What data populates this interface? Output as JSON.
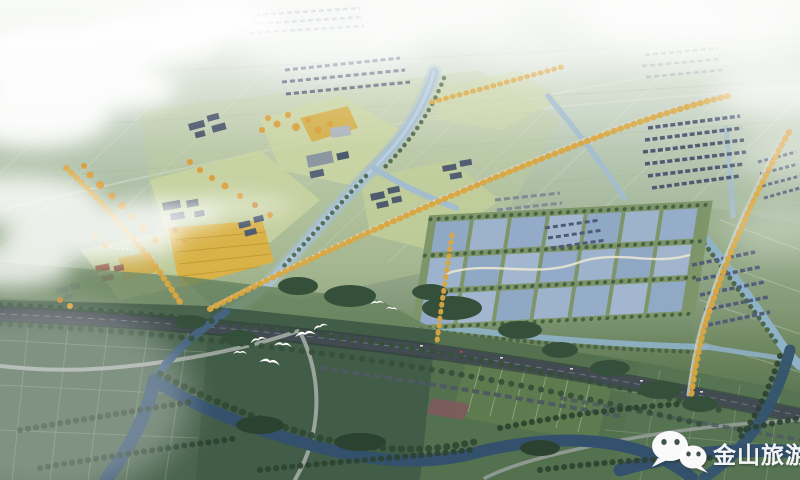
{
  "image": {
    "title": "Aerial bird's-eye rendering of a river-town masterplan",
    "description": "Hazy aerial view: town center with canals and golden tree-lined avenues, grid of aquaculture fish ponds, village housing rows, a tree-lined highway crossing the foreground farmland, white egrets in flight"
  },
  "watermark": {
    "brand": "金山旅游",
    "icon": "wechat-icon",
    "text_color": "#ffffff"
  },
  "features": {
    "sky": "hazy white clouds",
    "far_farmland": "pale field grid fading to horizon",
    "town_center": "riverside town with lawns and dark-roof buildings",
    "golden_avenues": "roads lined with golden autumn trees",
    "fish_ponds": "rectangular aquaculture pond grid",
    "village_rows": "rows of dark-roof village houses",
    "highway": "tree-lined dual highway",
    "canals": "winding blue canals and rivers",
    "foreground_fields": "dark green patchwork farmland",
    "birds": "white egrets flying"
  },
  "palette": {
    "haze": "#ecf1ea",
    "far_field": "#c2d1c0",
    "lawn": "#ccd6a0",
    "golden_field": "#d9b348",
    "autumn_tree": "#dba73f",
    "river_light": "#a5bfd0",
    "river_dark": "#33516c",
    "pond_blue": "#97aec9",
    "highway_gray": "#3c4449",
    "road_light": "#cfd6cc",
    "near_field": "#4e6750",
    "tree_dark": "#35503a",
    "roof_dark": "#4d5a6e",
    "roof_red": "#91604e",
    "cloud": "#ffffff",
    "bird": "#ffffff"
  }
}
